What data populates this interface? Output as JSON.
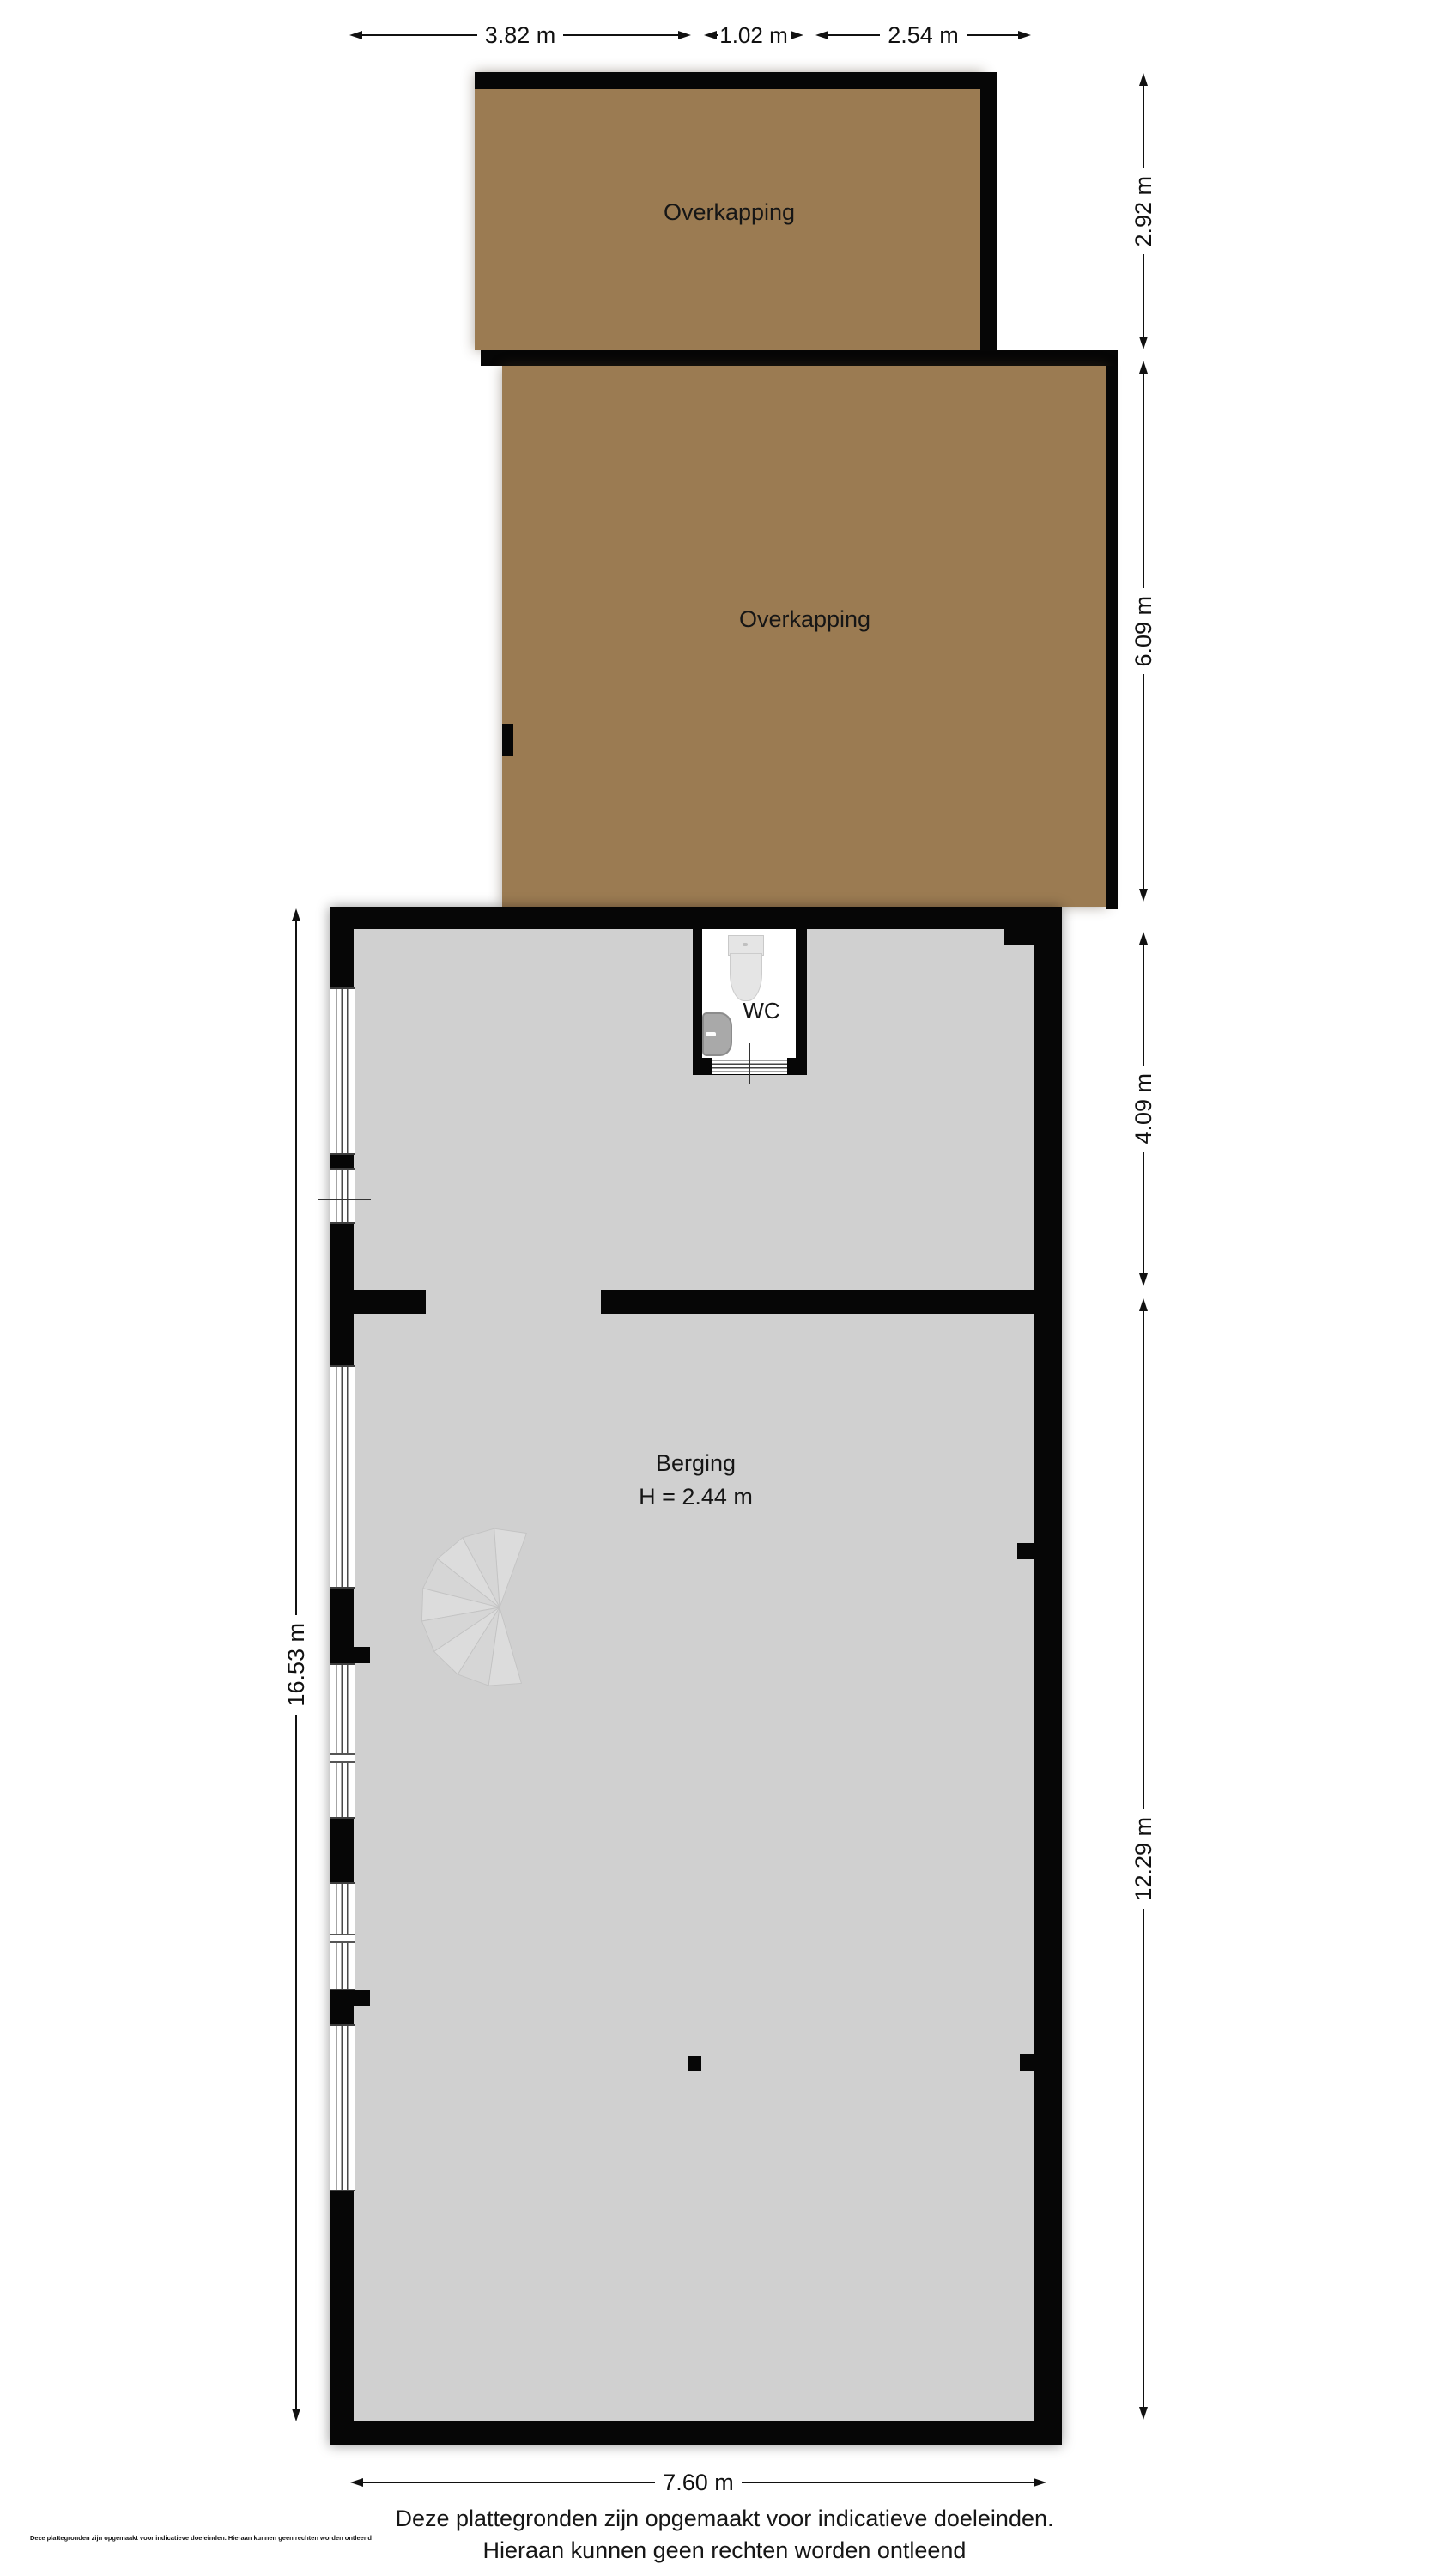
{
  "rooms": {
    "overkapping_top": {
      "label": "Overkapping"
    },
    "overkapping_main": {
      "label": "Overkapping"
    },
    "wc": {
      "label": "WC"
    },
    "berging": {
      "label": "Berging",
      "height_note": "H = 2.44 m"
    }
  },
  "dimensions": {
    "top": {
      "seg1": "3.82 m",
      "seg2": "1.02 m",
      "seg3": "2.54 m"
    },
    "right": {
      "seg1": "2.92 m",
      "seg2": "6.09 m",
      "seg3": "4.09 m",
      "seg4": "12.29 m"
    },
    "left": {
      "seg1": "16.53 m"
    },
    "bottom": {
      "seg1": "7.60 m"
    }
  },
  "footer": {
    "line1": "Deze plattegronden zijn opgemaakt voor indicatieve doeleinden.",
    "line2": "Hieraan kunnen geen rechten worden ontleend",
    "small_print": "Deze plattegronden zijn opgemaakt voor indicatieve doeleinden. Hieraan kunnen geen rechten worden ontleend"
  },
  "fixtures": {
    "toilet": "toilet",
    "sink": "sink",
    "stairs": "spiral-staircase"
  },
  "colors": {
    "canopy_fill": "#9b7b52",
    "floor_fill": "#d0d0d0",
    "wall": "#060606",
    "dimension_line": "#111111",
    "background": "#ffffff"
  }
}
